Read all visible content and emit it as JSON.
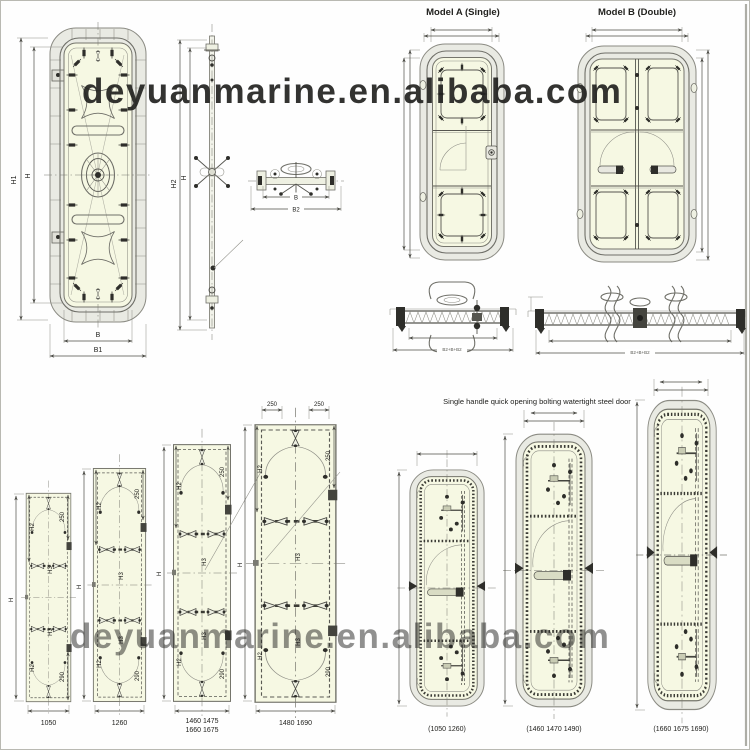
{
  "image": {
    "watermark_top": "deyuanmarine.en.alibaba.com",
    "watermark_bottom": "deyuanmarine.en.alibaba.com"
  },
  "overview": {
    "front_view": {
      "h1": "H1",
      "h": "H",
      "b": "B",
      "b1": "B1"
    },
    "side_view": {
      "h2": "H2",
      "h": "H"
    },
    "plan_view": {
      "b": "B",
      "b2": "B2"
    }
  },
  "models": {
    "model_a_title": "Model A (Single)",
    "model_b_title": "Model B (Double)",
    "section_single_dim": "B2+B+B2",
    "section_double_dim": "B2+B+B2"
  },
  "size_chart": {
    "dims": {
      "h": "H",
      "h2": "H2",
      "h3": "H3",
      "top": "250",
      "side_top": "250",
      "side_bottom": "290"
    },
    "doors": [
      {
        "width": "1050"
      },
      {
        "width": "1260"
      },
      {
        "width_line1": "1460 1475",
        "width_line2": "1660 1675"
      },
      {
        "width": "1480 1690"
      }
    ]
  },
  "quick_open": {
    "title": "Single handle quick opening bolting watertight steel door",
    "doors": [
      {
        "width": "(1050  1260)"
      },
      {
        "width": "(1460  1470  1490)"
      },
      {
        "width": "(1660  1675  1690)"
      }
    ]
  }
}
